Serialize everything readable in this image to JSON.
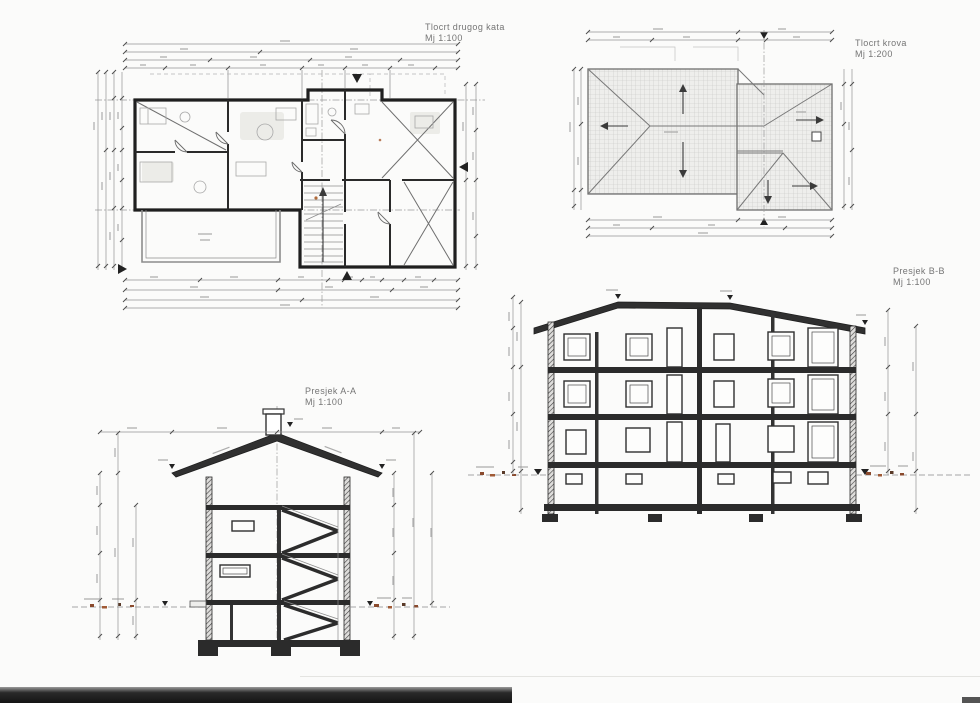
{
  "sheet": {
    "background": "#fbfbfa",
    "bottom_bar_color": "#141414",
    "line_color": "#1f1f1f",
    "dim_color": "#949494",
    "ground_mark_color": "#8a4a2d"
  },
  "drawings": {
    "floor_plan": {
      "title": "Tlocrt drugog kata",
      "scale": "Mj 1:100"
    },
    "roof_plan": {
      "title": "Tlocrt krova",
      "scale": "Mj 1:200"
    },
    "section_bb": {
      "title": "Presjek B-B",
      "scale": "Mj 1:100"
    },
    "section_aa": {
      "title": "Presjek  A-A",
      "scale": "Mj 1:100"
    }
  }
}
